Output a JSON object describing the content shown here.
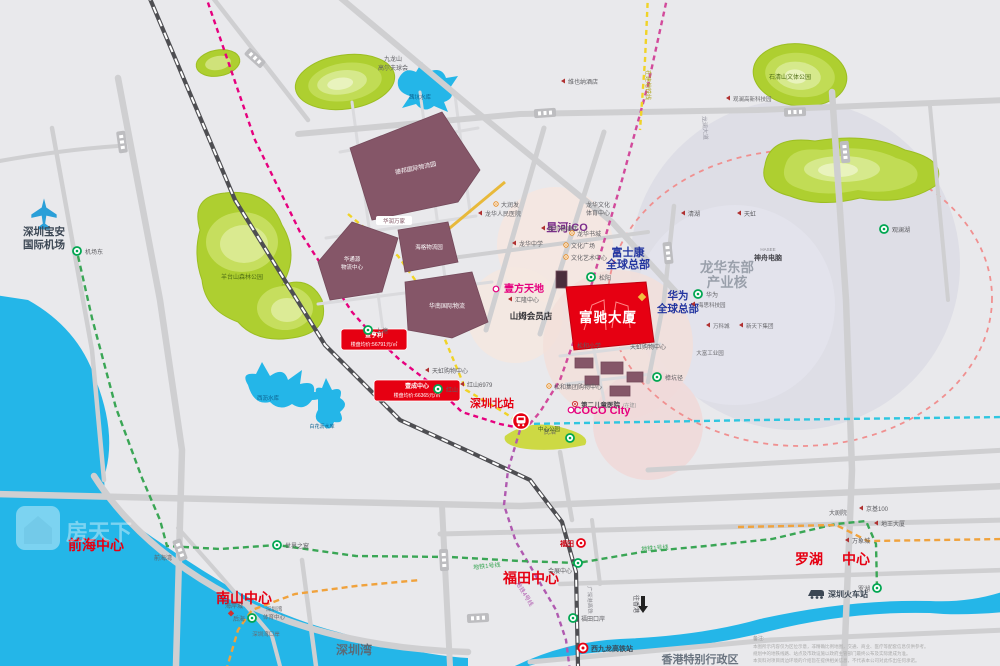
{
  "colors": {
    "background": "#e9e9ec",
    "accent_red": "#e60012",
    "brand_blue": "#2436a0",
    "magenta": "#e6007e",
    "metro_green": "#3aa655",
    "metro_cyan": "#2ec6e0",
    "metro_yellow": "#f0d327",
    "metro_orange": "#f0a23c",
    "metro_purple": "#b05ab0",
    "park_green": "#aecf30",
    "water_blue": "#24b6e8",
    "building_maroon": "#855668"
  },
  "poi": {
    "airport_l1": "深圳宝安",
    "airport_l2": "国际机场",
    "airport_east": "机场东",
    "jiulongshan_l1": "九龙山",
    "jiulongshan_l2": "高尔夫球会",
    "xikeng_reservoir": "茜坑水库",
    "vienna_hotel": "维也纳酒店",
    "metro_uc": "在建地铁线",
    "longlan_road": "龙澜大道",
    "shiqingshan_park": "石清山文体公园",
    "guanlan_tech_park": "观澜高新科技园",
    "guanlanhu": "观澜湖",
    "hasee_en": "HASEE",
    "hasee_cn": "神舟电脑",
    "qinghu": "清湖",
    "tianhong": "天虹",
    "logistics_debang": "德邦国际物流园",
    "crvanguard": "华润万家",
    "huatongyuan_l1": "华通源",
    "huatongyuan_l2": "物流中心",
    "haige": "海格物流园",
    "huanan_logistics": "华南国际物流",
    "darunfa": "大润发",
    "longhua_hospital": "龙华人民医院",
    "xinghe_ico": "星河iCO",
    "lh_culture_l1": "龙华文化",
    "lh_culture_l2": "体育中心",
    "hilton": "希尔顿酒店",
    "lh_bookcity": "龙华书城",
    "culture_square": "文化广场",
    "art_center": "文化艺术中心",
    "longhua_school": "龙华中学",
    "yifang_tiandi": "壹方天地",
    "huilong_center": "汇隆中心",
    "sams_club": "山姆会员店",
    "foxconn_l1": "富士康",
    "foxconn_l2": "全球总部",
    "songyang": "松阳",
    "fuchi_name": "富驰大厦",
    "huawei_l1": "华为",
    "huawei_l2": "全球总部",
    "huawei_station": "华为",
    "longhua_east_l1": "龙华东部",
    "longhua_east_l2": "产业核",
    "hisilicon": "海思科技园",
    "vanke_city": "万科城",
    "xintianxia": "新天下集团",
    "dafu_park": "大富工业园",
    "zhangkengjing": "樟坑径",
    "songhe_school": "松和小学",
    "tianhong_mall_e": "天虹购物中心",
    "tianhong_mall_w": "天虹购物中心",
    "songhe_mall": "松和集团购物中心",
    "children_hospital": "第二儿童医院",
    "children_note": "(在建)",
    "hongshan_6979": "红山6979",
    "hongshan": "红山",
    "shangtang": "上塘",
    "minzhi": "民治",
    "coco_city": "COCO City",
    "szn_station": "深圳北站",
    "center_park": "中心公园",
    "yangtai_park": "羊台山森林公园",
    "xili_reservoir": "西沥水库",
    "baihuali_reservoir": "白花沥水库",
    "qianhai_center": "前海中心",
    "nanshan_center": "南山中心",
    "futian_center": "福田中心",
    "luohu_center_l1": "罗湖",
    "luohu_center_l2": "中心",
    "qianhaiwan": "前海湾",
    "window_world": "世界之窗",
    "coast_city": "海岸城",
    "houhai": "后海",
    "szbay_sports_l1": "深圳湾",
    "szbay_sports_l2": "体育中心",
    "szbay_port": "深圳湾口岸",
    "shenzhen_bay": "深圳湾",
    "line1_label_w": "地铁1号线",
    "line1_label_e": "地铁1号线",
    "line4_label": "地铁4号线",
    "hsr_label": "广深港高铁",
    "exhibition_center": "会展中心",
    "futian_station": "福田",
    "futian_port": "福田口岸",
    "to_hongkong": "往香港",
    "west_kowloon": "西九龙高铁站",
    "theater": "大剧院",
    "kk100": "京基100",
    "diwang": "地王大厦",
    "mixc": "万象城",
    "luohu_station": "罗湖",
    "sz_railway": "深圳火车站",
    "hongkong_sar": "香港特别行政区",
    "watermark": "房天下"
  },
  "price_tags": {
    "tag1_name": "金亨利",
    "tag1_price": "楼盘均价:56791元/㎡",
    "tag2_name": "壹成中心",
    "tag2_price": "楼盘均价:66365元/㎡"
  },
  "notes": {
    "title": "备注:",
    "l1": "本图所示内容仅为区位示意，非精确比例地图，交通、商业、医疗等配套信息仅供参考。",
    "l2": "规划中的地铁线路、站点及市政设施以政府主管部门最终公布及实际建成为准。",
    "l3": "本资料对项目周边环境的介绍旨在提供相关信息，不代表本公司对此作出任何承诺。"
  }
}
